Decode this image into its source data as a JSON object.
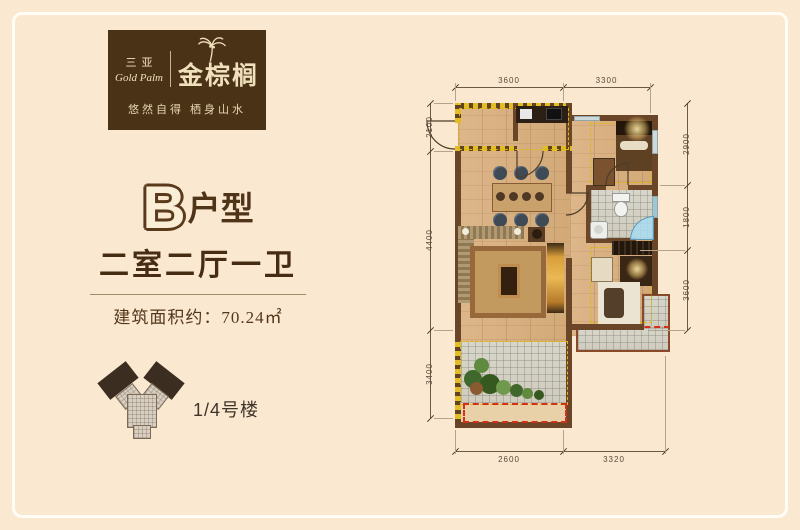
{
  "page": {
    "background": "#fbe8d1",
    "frame_color": "#fffdf6"
  },
  "logo": {
    "brand_cn_small": "三亚",
    "brand_en": "Gold Palm",
    "brand_cn_large": "金棕榈",
    "tagline": "悠然自得 栖身山水",
    "box_color": "#4a3216",
    "text_color": "#f0e0bc",
    "palm_icon": "palm-tree-icon"
  },
  "unit": {
    "type_letter": "B",
    "type_suffix": "户型",
    "layout": "二室二厅一卫",
    "area_label": "建筑面积约：70.24㎡",
    "building_label": "1/4号楼",
    "footprint_icon": "building-footprint-icon"
  },
  "plan": {
    "dims": {
      "top": [
        "3600",
        "3300"
      ],
      "bottom": [
        "2600",
        "3320"
      ],
      "left": [
        "2100",
        "4400",
        "3400"
      ],
      "right": [
        "2900",
        "1800",
        "3600"
      ]
    },
    "colors": {
      "wall": "#6b4527",
      "wood_floor": "#d9b183",
      "tile": "#d5d2c5",
      "marking_yellow": "#e3bd25",
      "marking_red": "#d23018",
      "glass_blue": "#a8dcf2"
    }
  }
}
